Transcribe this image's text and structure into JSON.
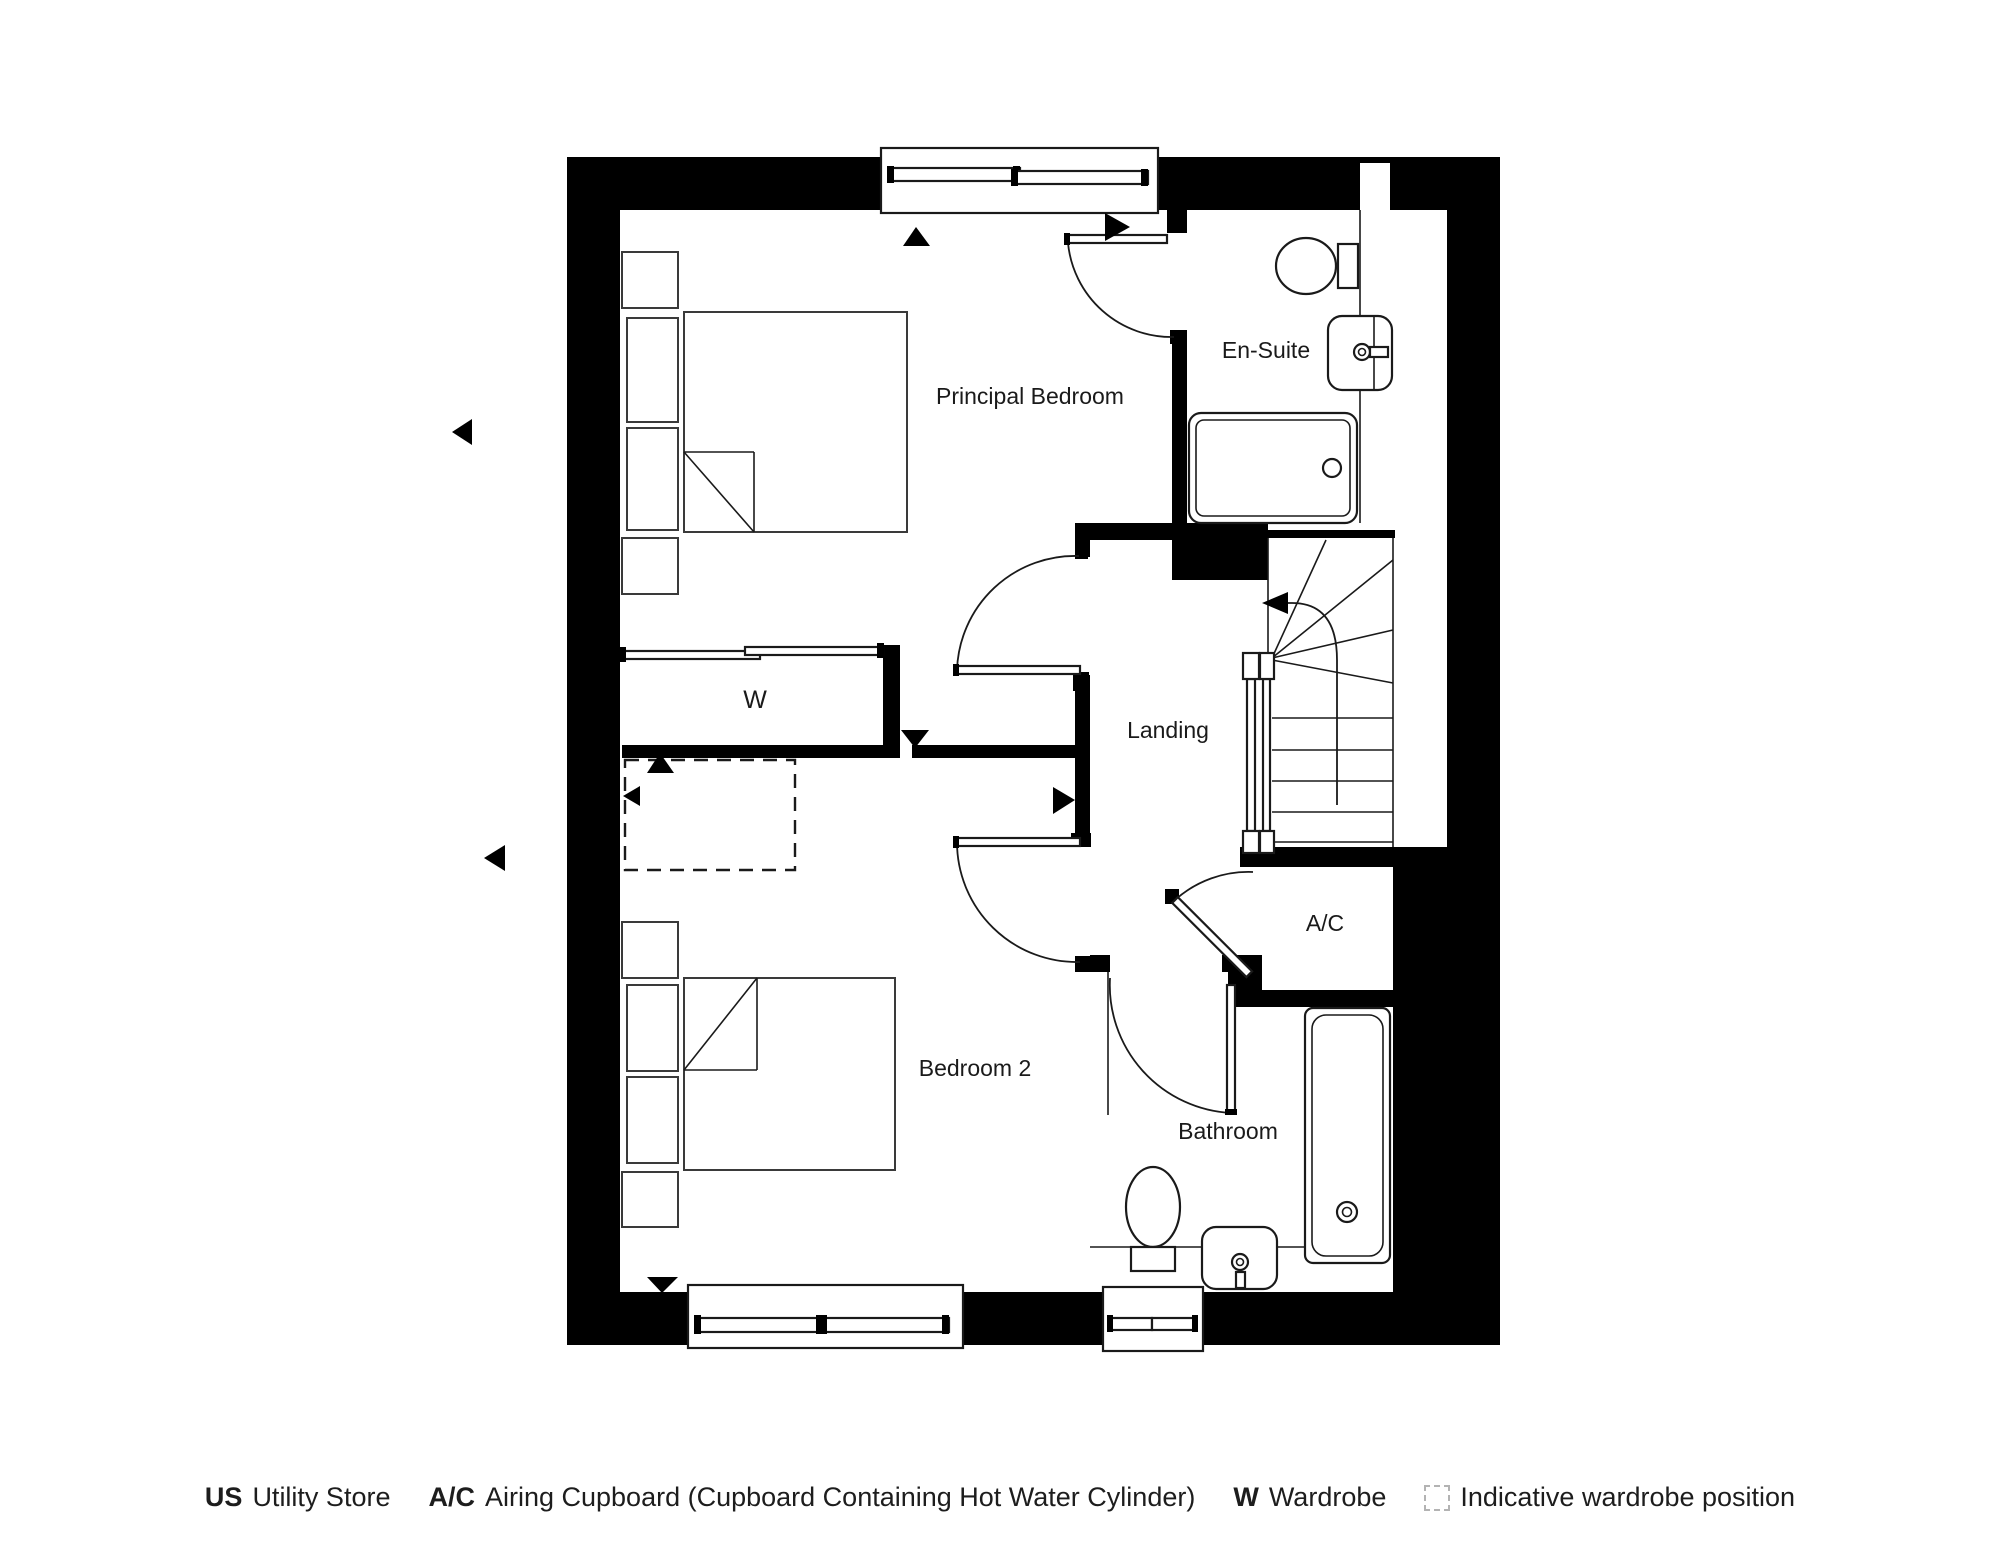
{
  "rooms": {
    "principal_bedroom": {
      "label": "Principal Bedroom"
    },
    "en_suite": {
      "label": "En-Suite"
    },
    "landing": {
      "label": "Landing"
    },
    "wardrobe": {
      "label": "W"
    },
    "bedroom_2": {
      "label": "Bedroom 2"
    },
    "airing_cupboard": {
      "label": "A/C"
    },
    "bathroom": {
      "label": "Bathroom"
    }
  },
  "legend": {
    "items": [
      {
        "key": "US",
        "label": "Utility Store"
      },
      {
        "key": "A/C",
        "label": "Airing Cupboard (Cupboard Containing Hot Water Cylinder)"
      },
      {
        "key": "W",
        "label": "Wardrobe"
      },
      {
        "key": "",
        "icon": "dashed-box-icon",
        "label": "Indicative wardrobe position"
      }
    ]
  },
  "colors": {
    "wall": "#000000",
    "line": "#1a1a1a",
    "background": "#ffffff",
    "text": "#1d1d1d"
  }
}
